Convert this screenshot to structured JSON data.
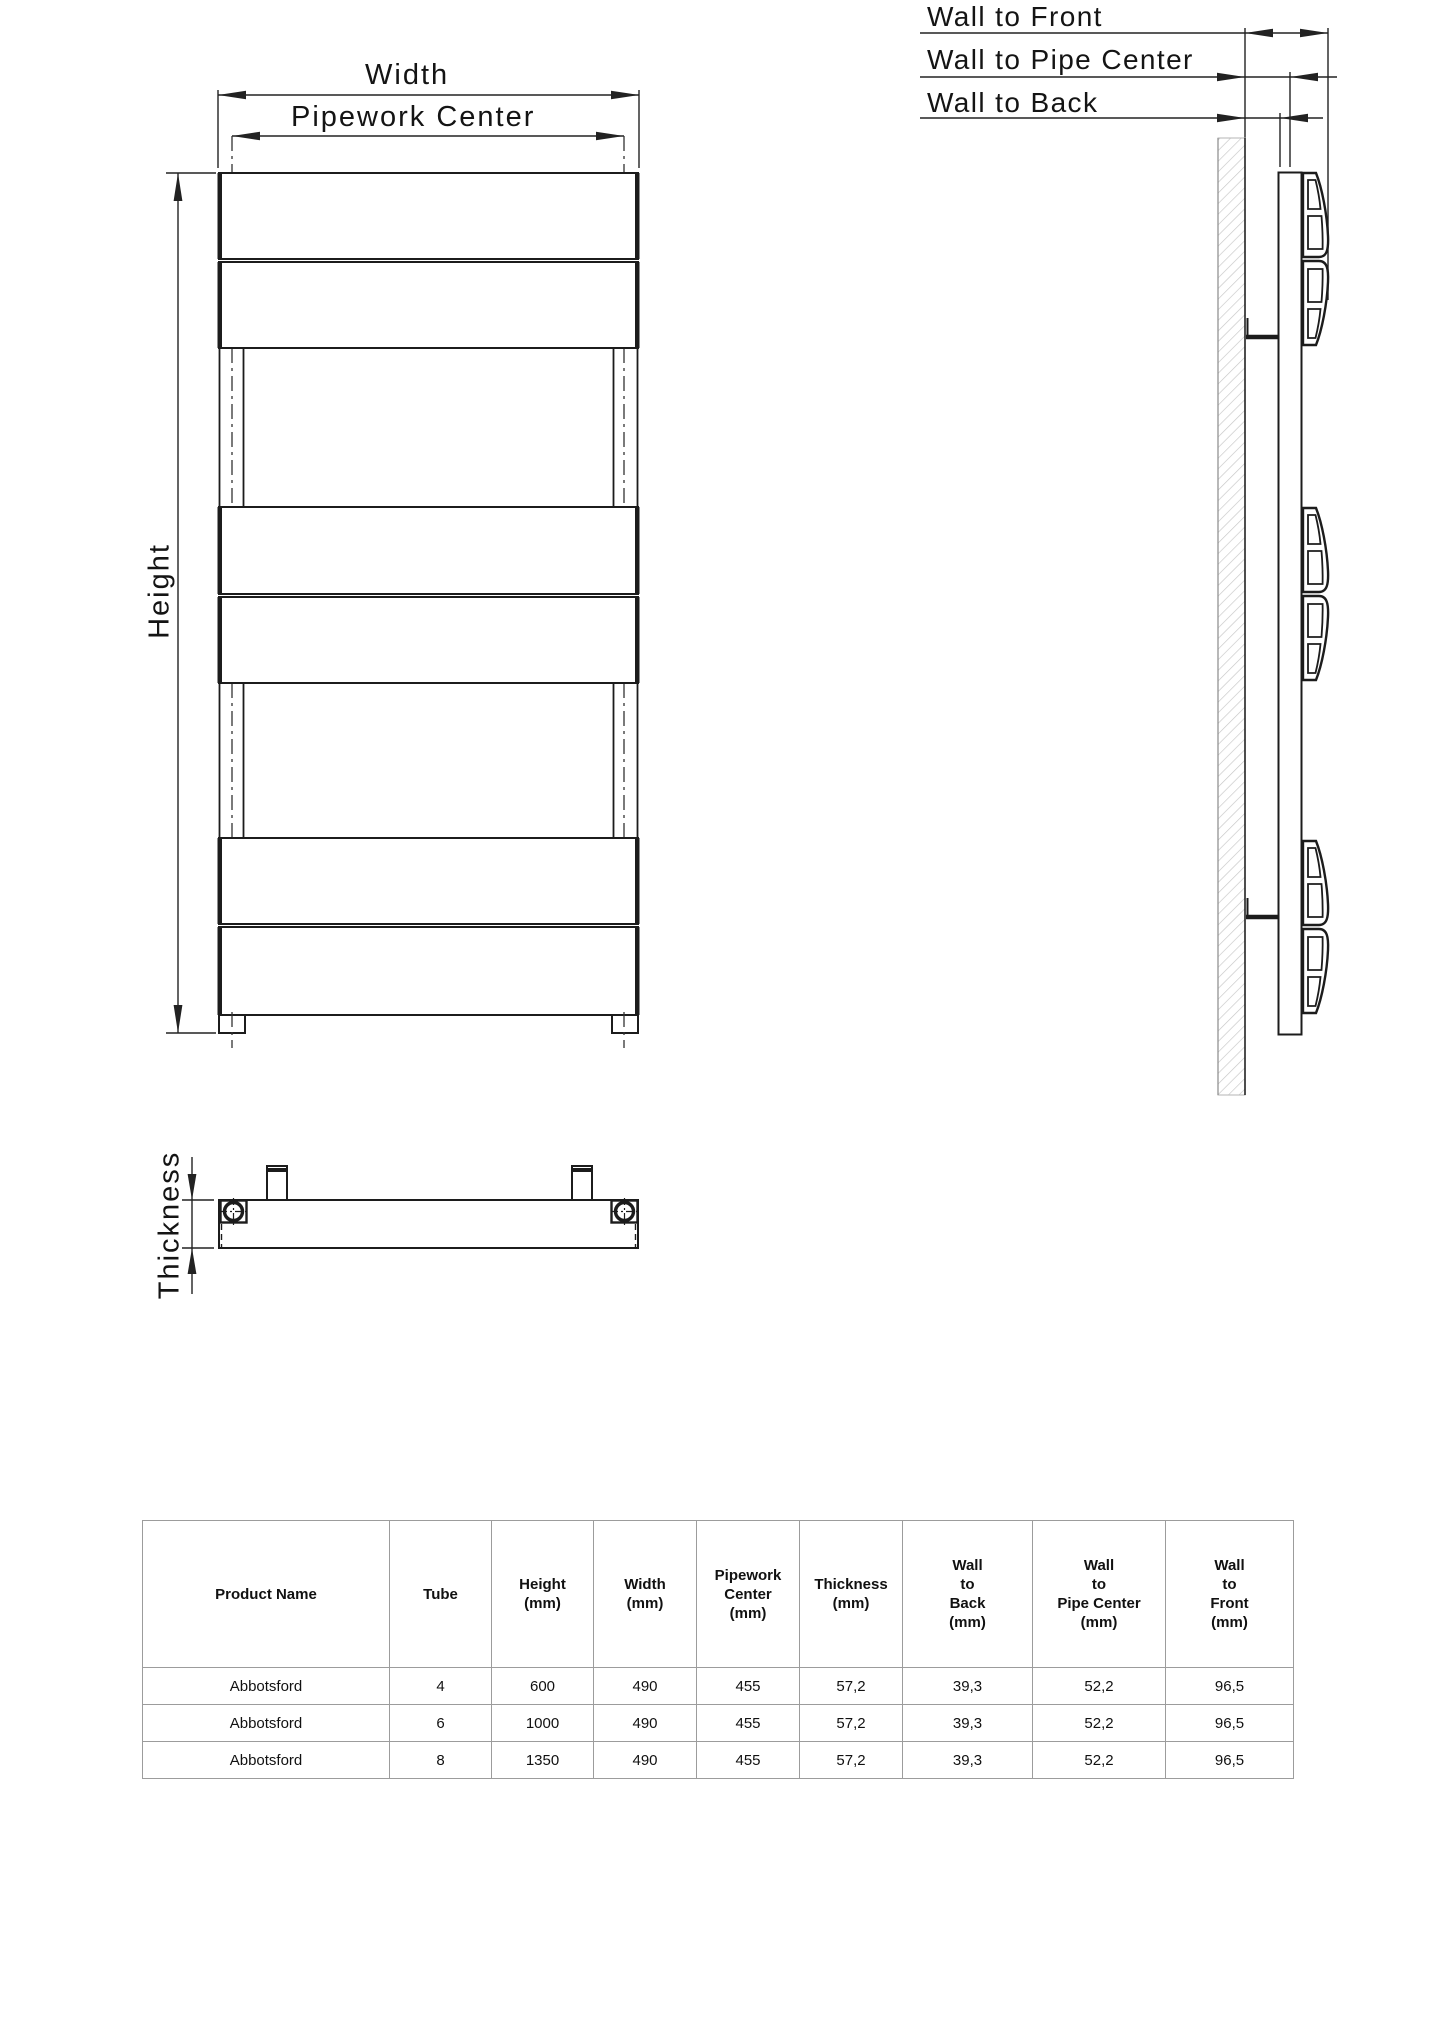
{
  "front_view": {
    "width_label": "Width",
    "pipework_center_label": "Pipework Center",
    "height_label": "Height"
  },
  "side_view": {
    "wall_to_front_label": "Wall to Front",
    "wall_to_pipe_center_label": "Wall to Pipe Center",
    "wall_to_back_label": "Wall to Back"
  },
  "plan_view": {
    "thickness_label": "Thickness"
  },
  "spec_table": {
    "headers": [
      "Product Name",
      "Tube",
      "Height\n(mm)",
      "Width\n(mm)",
      "Pipework\nCenter\n(mm)",
      "Thickness\n(mm)",
      "Wall\nto\nBack\n(mm)",
      "Wall\nto\nPipe Center\n(mm)",
      "Wall\nto\nFront\n(mm)"
    ],
    "rows": [
      [
        "Abbotsford",
        "4",
        "600",
        "490",
        "455",
        "57,2",
        "39,3",
        "52,2",
        "96,5"
      ],
      [
        "Abbotsford",
        "6",
        "1000",
        "490",
        "455",
        "57,2",
        "39,3",
        "52,2",
        "96,5"
      ],
      [
        "Abbotsford",
        "8",
        "1350",
        "490",
        "455",
        "57,2",
        "39,3",
        "52,2",
        "96,5"
      ]
    ]
  },
  "colors": {
    "line": "#1c1c1c",
    "dim_line": "#222222",
    "wall_hatch": "#c6c6c6",
    "table_border": "#9c9c9c",
    "background": "#ffffff"
  }
}
